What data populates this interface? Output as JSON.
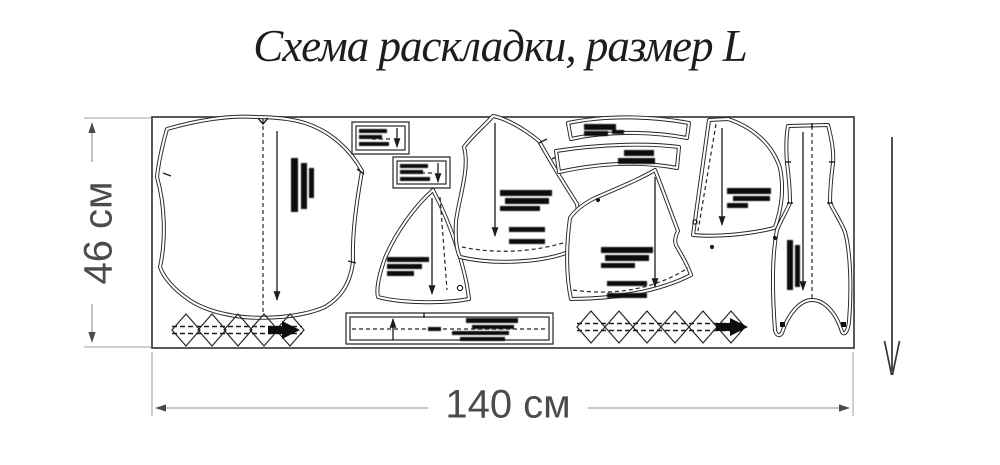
{
  "title": "Схема раскладки, размер L",
  "diagram": {
    "fabric_height_label": "46 см",
    "fabric_width_label": "140 см"
  },
  "colors": {
    "outline": "#262626",
    "dimension_text": "#4b4b4b",
    "dimension_line": "#8f8f8f",
    "title_text": "#1d1d1d",
    "background": "#ffffff"
  }
}
